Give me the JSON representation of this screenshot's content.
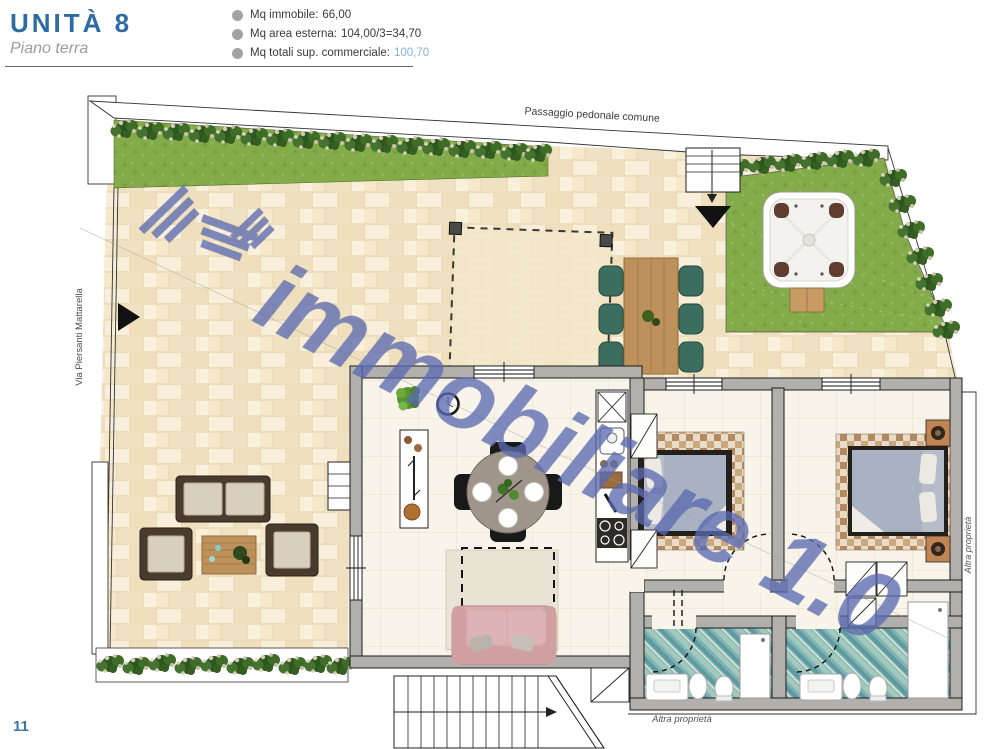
{
  "header": {
    "title": "UNITÀ 8",
    "subtitle": "Piano terra",
    "specs": [
      {
        "label": "Mq immobile:",
        "value": "66,00"
      },
      {
        "label": "Mq area esterna:",
        "value": "104,00/3=34,70"
      },
      {
        "label": "Mq totali sup. commerciale:",
        "value": "100,70"
      }
    ]
  },
  "plan": {
    "watermark": "immobiliare 1.0",
    "labels": {
      "walkway": "Passaggio pedonale comune",
      "street": "Via Piersanti Mattarella",
      "other_property_right": "Altra proprietà",
      "other_property_bottom": "Altra proprietà"
    }
  },
  "page": {
    "number": "11"
  },
  "palette": {
    "title_blue": "#2d6ca2",
    "value_blue": "#82b4d8",
    "watermark_blue": "#5b6ab0",
    "wall_gray": "#b2b0ad",
    "patio_beige": "#f1e0bf",
    "grass_green": "#83ab49",
    "bath_teal": "#7db3b4",
    "sofa_pink": "#d8abad",
    "wood_brown": "#bd9159"
  }
}
